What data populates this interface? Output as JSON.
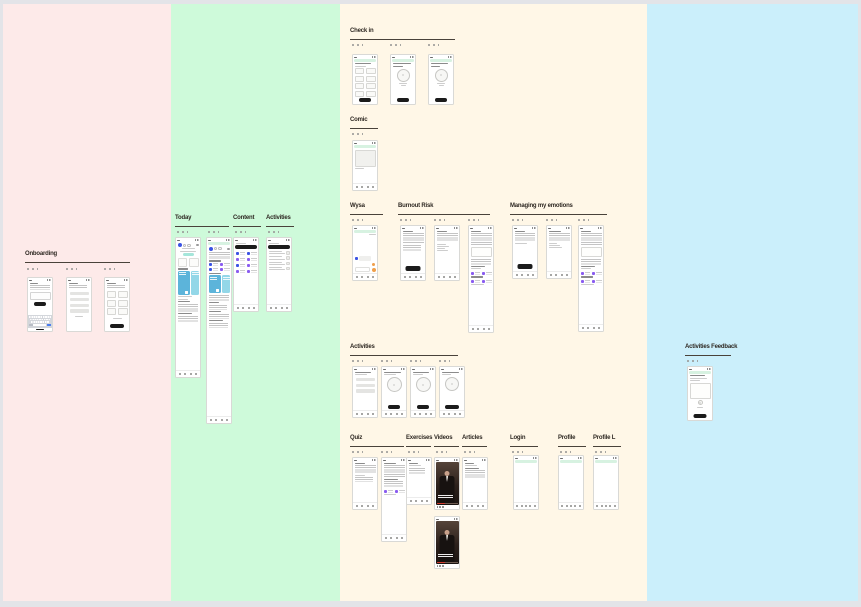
{
  "canvas": {
    "background": "#e3e4e8",
    "columns": {
      "pink": "#fdeae9",
      "green": "#cefada",
      "cream": "#fff7e7",
      "blue": "#cbeffb"
    }
  },
  "sections": {
    "onboarding": {
      "title": "Onboarding",
      "frames": 3
    },
    "today": {
      "title": "Today",
      "frames": 2
    },
    "content": {
      "title": "Content",
      "frames": 1
    },
    "activities_green": {
      "title": "Activities",
      "frames": 1
    },
    "check_in": {
      "title": "Check in",
      "frames": 3
    },
    "comic": {
      "title": "Comic",
      "frames": 1
    },
    "wysa": {
      "title": "Wysa",
      "frames": 1
    },
    "burnout_risk": {
      "title": "Burnout Risk",
      "frames": 3
    },
    "managing_my_emotions": {
      "title": "Managing my emotions",
      "frames": 3
    },
    "activities_cream": {
      "title": "Activities",
      "frames": 4
    },
    "quiz": {
      "title": "Quiz",
      "frames": 2
    },
    "exercises": {
      "title": "Exercises",
      "frames": 1
    },
    "videos": {
      "title": "Videos",
      "frames": 2
    },
    "articles": {
      "title": "Articles",
      "frames": 1
    },
    "login": {
      "title": "Login",
      "frames": 1
    },
    "profile": {
      "title": "Profile",
      "frames": 1
    },
    "profile_l": {
      "title": "Profile L",
      "frames": 1
    },
    "activities_feedback": {
      "title": "Activities Feedback",
      "frames": 1
    }
  },
  "accents": {
    "primary_blue": "#3b53e4",
    "purple": "#8a5cf0",
    "sky_card": "#5cb4da",
    "cyan_card": "#93d7e8",
    "mint_bar": "#d7f2e1",
    "teal_pill": "#a5e6da",
    "orange": "#ef9f4b",
    "button_black": "#1b1b1b",
    "keyboard_blue": "#4a7df0",
    "video_red": "#d23b2f"
  }
}
